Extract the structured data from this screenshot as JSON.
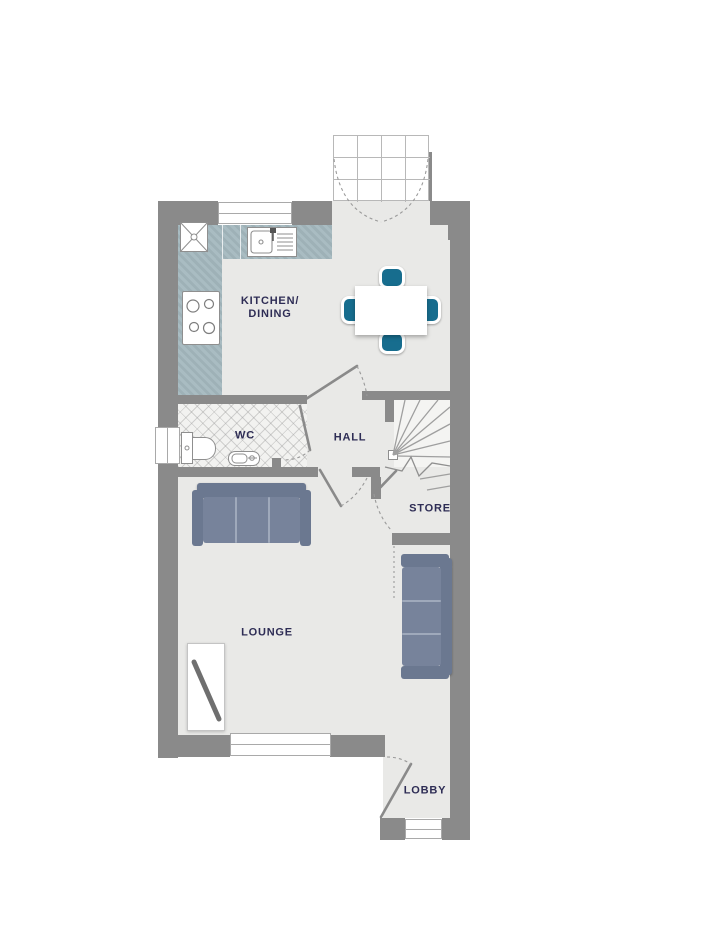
{
  "rooms": {
    "kitchen_dining": {
      "label_line1": "KITCHEN/",
      "label_line2": "DINING"
    },
    "wc": {
      "label": "WC"
    },
    "hall": {
      "label": "HALL"
    },
    "store": {
      "label": "STORE"
    },
    "lounge": {
      "label": "LOUNGE"
    },
    "lobby": {
      "label": "LOBBY"
    }
  },
  "fixtures": {
    "kitchen": [
      "washing-machine",
      "sink-with-drainer",
      "hob",
      "worktop"
    ],
    "dining": [
      "dining-table",
      "chair",
      "chair",
      "chair",
      "chair"
    ],
    "wc": [
      "toilet",
      "basin",
      "window"
    ],
    "stairs": [
      "winder-stairs",
      "newel-post"
    ],
    "lounge": [
      "sofa",
      "sofa",
      "tv-unit",
      "window"
    ],
    "lobby": [
      "entrance-door",
      "window"
    ],
    "exterior": [
      "french-doors"
    ]
  },
  "colors": {
    "wall": "#8a8a8a",
    "floor": "#e9e9e7",
    "floor_light": "#f4f4f2",
    "counter": "#a3b7bd",
    "accent": "#176d8e",
    "sofa": "#77839b",
    "sofa_dark": "#6b7890",
    "seam": "#9fa9bb",
    "label": "#2e2d55",
    "line": "#9b9b9b",
    "tv": "#6f6f6f",
    "window_frame": "#a9a9a9"
  }
}
